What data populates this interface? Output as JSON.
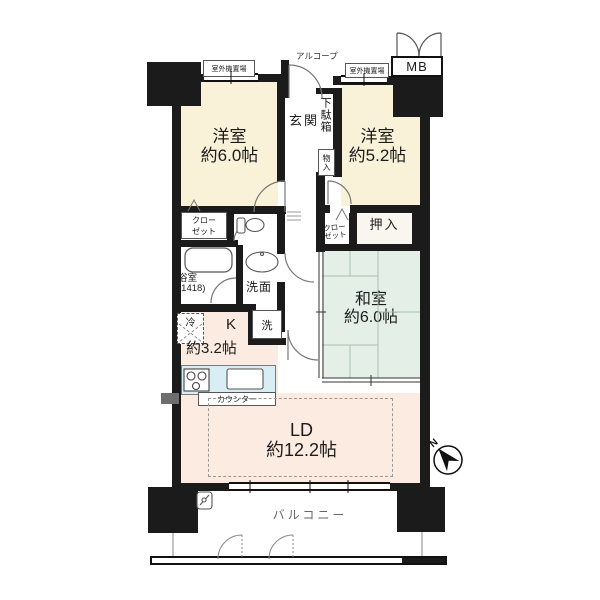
{
  "labels": {
    "mb": "MB",
    "alcove": "アルコープ",
    "outdoor_unit_left": "室外機置場",
    "outdoor_unit_right": "室外機置場",
    "entrance": "玄関",
    "shoe_box": "下駄箱",
    "storage": "物入",
    "closet_line1": "クロー",
    "closet_line2": "ゼット",
    "oshiire": "押入",
    "bath": "浴室",
    "bath_size": "(1418)",
    "washroom": "洗面",
    "washer": "洗",
    "fridge": "冷",
    "counter": "カウンター",
    "balcony": "バルコニー",
    "compass_n": "N"
  },
  "rooms": {
    "western1": {
      "name": "洋室",
      "size": "約6.0帖"
    },
    "western2": {
      "name": "洋室",
      "size": "約5.2帖"
    },
    "japanese": {
      "name": "和室",
      "size": "約6.0帖"
    },
    "living_dining": {
      "name": "LD",
      "size": "約12.2帖"
    },
    "kitchen": {
      "name": "K",
      "size": "約3.2帖"
    }
  },
  "colors": {
    "wall": "#1b1b1b",
    "western_room": "#f9f2d8",
    "japanese_room": "#e4efe7",
    "living_kitchen": "#fcebe1",
    "counter_top": "#d9edf5"
  }
}
